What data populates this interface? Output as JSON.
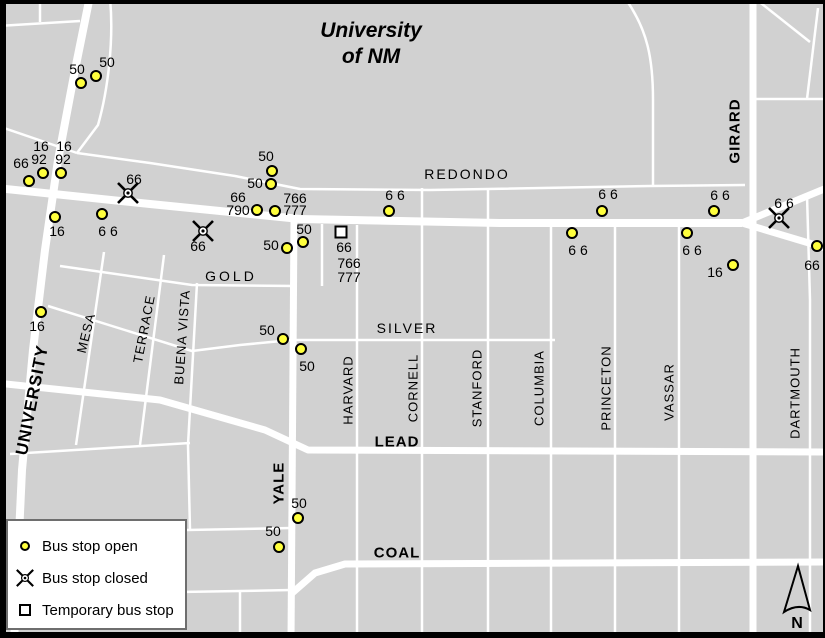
{
  "title": {
    "line1": "University",
    "line2": "of NM"
  },
  "north": {
    "label": "N"
  },
  "legend": {
    "items": [
      {
        "type": "open",
        "label": "Bus stop open"
      },
      {
        "type": "closed",
        "label": "Bus stop closed"
      },
      {
        "type": "temporary",
        "label": "Temporary bus stop"
      }
    ]
  },
  "colors": {
    "background": "#d1d1d1",
    "street": "#ffffff",
    "stop_open_fill": "#ffff3d",
    "marker_outline": "#000000",
    "frame": "#000000",
    "legend_border": "#6e6e6e"
  },
  "street_labels": [
    {
      "text": "REDONDO",
      "x": 467,
      "y": 174,
      "rot": 0,
      "bold": false,
      "size": 14,
      "spacing": 2
    },
    {
      "text": "GOLD",
      "x": 231,
      "y": 276,
      "rot": 0,
      "bold": false,
      "size": 14,
      "spacing": 3
    },
    {
      "text": "SILVER",
      "x": 407,
      "y": 328,
      "rot": 0,
      "bold": false,
      "size": 14,
      "spacing": 2
    },
    {
      "text": "LEAD",
      "x": 397,
      "y": 442,
      "rot": 0,
      "bold": true,
      "size": 15,
      "spacing": 1
    },
    {
      "text": "COAL",
      "x": 397,
      "y": 553,
      "rot": 0,
      "bold": true,
      "size": 15,
      "spacing": 1
    },
    {
      "text": "UNIVERSITY",
      "x": 32,
      "y": 400,
      "rot": -79,
      "bold": true,
      "size": 17,
      "spacing": 1
    },
    {
      "text": "MESA",
      "x": 86,
      "y": 333,
      "rot": -76,
      "bold": false,
      "size": 13,
      "spacing": 1
    },
    {
      "text": "TERRACE",
      "x": 144,
      "y": 329,
      "rot": -79,
      "bold": false,
      "size": 13,
      "spacing": 1
    },
    {
      "text": "BUENA VISTA",
      "x": 182,
      "y": 337,
      "rot": -86,
      "bold": false,
      "size": 13,
      "spacing": 1
    },
    {
      "text": "YALE",
      "x": 279,
      "y": 483,
      "rot": -90,
      "bold": true,
      "size": 15,
      "spacing": 1
    },
    {
      "text": "HARVARD",
      "x": 348,
      "y": 390,
      "rot": -90,
      "bold": false,
      "size": 13,
      "spacing": 1
    },
    {
      "text": "CORNELL",
      "x": 413,
      "y": 388,
      "rot": -90,
      "bold": false,
      "size": 13,
      "spacing": 1
    },
    {
      "text": "STANFORD",
      "x": 477,
      "y": 388,
      "rot": -90,
      "bold": false,
      "size": 13,
      "spacing": 1
    },
    {
      "text": "COLUMBIA",
      "x": 539,
      "y": 388,
      "rot": -90,
      "bold": false,
      "size": 13,
      "spacing": 1
    },
    {
      "text": "PRINCETON",
      "x": 606,
      "y": 388,
      "rot": -90,
      "bold": false,
      "size": 13,
      "spacing": 1
    },
    {
      "text": "VASSAR",
      "x": 669,
      "y": 392,
      "rot": -90,
      "bold": false,
      "size": 13,
      "spacing": 1
    },
    {
      "text": "DARTMOUTH",
      "x": 795,
      "y": 393,
      "rot": -90,
      "bold": false,
      "size": 13,
      "spacing": 1
    },
    {
      "text": "GIRARD",
      "x": 735,
      "y": 131,
      "rot": -90,
      "bold": true,
      "size": 15,
      "spacing": 1
    }
  ],
  "stops": [
    {
      "type": "open",
      "x": 81,
      "y": 83,
      "labels": [
        {
          "text": "50",
          "x": 77,
          "y": 69
        }
      ]
    },
    {
      "type": "open",
      "x": 96,
      "y": 76,
      "labels": [
        {
          "text": "50",
          "x": 107,
          "y": 62
        }
      ]
    },
    {
      "type": "open",
      "x": 29,
      "y": 181,
      "labels": [
        {
          "text": "66",
          "x": 21,
          "y": 163
        }
      ]
    },
    {
      "type": "open",
      "x": 43,
      "y": 173,
      "labels": [
        {
          "text": "16",
          "x": 41,
          "y": 146
        },
        {
          "text": "92",
          "x": 39,
          "y": 159
        }
      ]
    },
    {
      "type": "open",
      "x": 61,
      "y": 173,
      "labels": [
        {
          "text": "16",
          "x": 64,
          "y": 146
        },
        {
          "text": "92",
          "x": 63,
          "y": 159
        }
      ]
    },
    {
      "type": "open",
      "x": 55,
      "y": 217,
      "labels": [
        {
          "text": "16",
          "x": 57,
          "y": 231
        }
      ]
    },
    {
      "type": "open",
      "x": 102,
      "y": 214,
      "labels": [
        {
          "text": "6 6",
          "x": 108,
          "y": 231
        }
      ]
    },
    {
      "type": "open",
      "x": 41,
      "y": 312,
      "labels": [
        {
          "text": "16",
          "x": 37,
          "y": 326
        }
      ]
    },
    {
      "type": "open",
      "x": 272,
      "y": 171,
      "labels": [
        {
          "text": "50",
          "x": 266,
          "y": 156
        }
      ]
    },
    {
      "type": "open",
      "x": 271,
      "y": 184,
      "labels": [
        {
          "text": "50",
          "x": 255,
          "y": 183
        }
      ]
    },
    {
      "type": "open",
      "x": 257,
      "y": 210,
      "labels": [
        {
          "text": "66",
          "x": 238,
          "y": 197
        },
        {
          "text": "790",
          "x": 238,
          "y": 210
        }
      ]
    },
    {
      "type": "open",
      "x": 275,
      "y": 211,
      "labels": [
        {
          "text": "766",
          "x": 295,
          "y": 198
        },
        {
          "text": "777",
          "x": 295,
          "y": 210
        }
      ]
    },
    {
      "type": "open",
      "x": 389,
      "y": 211,
      "labels": [
        {
          "text": "6 6",
          "x": 395,
          "y": 195
        }
      ]
    },
    {
      "type": "open",
      "x": 303,
      "y": 242,
      "labels": [
        {
          "text": "50",
          "x": 304,
          "y": 229
        }
      ]
    },
    {
      "type": "open",
      "x": 287,
      "y": 248,
      "labels": [
        {
          "text": "50",
          "x": 271,
          "y": 245
        }
      ]
    },
    {
      "type": "open",
      "x": 283,
      "y": 339,
      "labels": [
        {
          "text": "50",
          "x": 267,
          "y": 330
        }
      ]
    },
    {
      "type": "open",
      "x": 301,
      "y": 349,
      "labels": [
        {
          "text": "50",
          "x": 307,
          "y": 366
        }
      ]
    },
    {
      "type": "open",
      "x": 602,
      "y": 211,
      "labels": [
        {
          "text": "6 6",
          "x": 608,
          "y": 194
        }
      ]
    },
    {
      "type": "open",
      "x": 714,
      "y": 211,
      "labels": [
        {
          "text": "6 6",
          "x": 720,
          "y": 195
        }
      ]
    },
    {
      "type": "open",
      "x": 572,
      "y": 233,
      "labels": [
        {
          "text": "6 6",
          "x": 578,
          "y": 250
        }
      ]
    },
    {
      "type": "open",
      "x": 687,
      "y": 233,
      "labels": [
        {
          "text": "6 6",
          "x": 692,
          "y": 250
        }
      ]
    },
    {
      "type": "open",
      "x": 733,
      "y": 265,
      "labels": [
        {
          "text": "16",
          "x": 715,
          "y": 272
        }
      ]
    },
    {
      "type": "open",
      "x": 817,
      "y": 246,
      "labels": [
        {
          "text": "66",
          "x": 812,
          "y": 265
        }
      ]
    },
    {
      "type": "open",
      "x": 298,
      "y": 518,
      "labels": [
        {
          "text": "50",
          "x": 299,
          "y": 503
        }
      ]
    },
    {
      "type": "open",
      "x": 279,
      "y": 547,
      "labels": [
        {
          "text": "50",
          "x": 273,
          "y": 531
        }
      ]
    },
    {
      "type": "closed",
      "x": 128,
      "y": 193,
      "labels": [
        {
          "text": "66",
          "x": 134,
          "y": 179
        }
      ]
    },
    {
      "type": "closed",
      "x": 203,
      "y": 231,
      "labels": [
        {
          "text": "66",
          "x": 198,
          "y": 246
        }
      ]
    },
    {
      "type": "closed",
      "x": 779,
      "y": 218,
      "labels": [
        {
          "text": "6 6",
          "x": 784,
          "y": 203
        }
      ]
    },
    {
      "type": "temporary",
      "x": 341,
      "y": 232,
      "labels": [
        {
          "text": "66",
          "x": 344,
          "y": 247
        },
        {
          "text": "766",
          "x": 349,
          "y": 263
        },
        {
          "text": "777",
          "x": 349,
          "y": 277
        }
      ]
    }
  ]
}
